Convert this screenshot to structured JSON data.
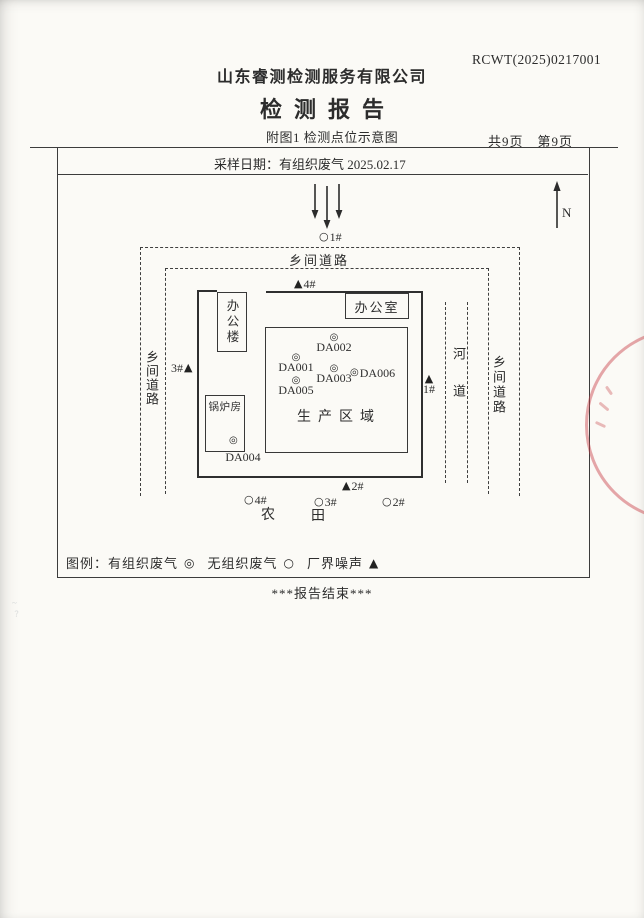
{
  "header": {
    "report_no": "RCWT(2025)0217001",
    "company": "山东睿测检测服务有限公司",
    "title": "检测报告",
    "figure_caption": "附图1 检测点位示意图",
    "page_info": "共9页　第9页",
    "sampling_date_row": "采样日期：有组织废气 2025.02.17"
  },
  "diagram": {
    "north_label": "N",
    "roads": {
      "top": "乡间道路",
      "left": "乡间道路",
      "right": "乡间道路"
    },
    "river_label": "河道",
    "office_building": "办公楼",
    "office_room": "办公室",
    "boiler_room": "锅炉房",
    "production_area": "生产区域",
    "farmland": {
      "char1": "农",
      "char2": "田"
    },
    "symbols": {
      "organized": "◎",
      "unorganized": "○",
      "noise": "▲"
    },
    "organized_points": [
      {
        "id": "DA001"
      },
      {
        "id": "DA002"
      },
      {
        "id": "DA003"
      },
      {
        "id": "DA004"
      },
      {
        "id": "DA005"
      },
      {
        "id": "DA006"
      }
    ],
    "noise_points": [
      {
        "id": "1#"
      },
      {
        "id": "2#"
      },
      {
        "id": "3#"
      },
      {
        "id": "4#"
      }
    ],
    "unorganized_points": [
      {
        "id": "1#"
      },
      {
        "id": "2#"
      },
      {
        "id": "3#"
      },
      {
        "id": "4#"
      }
    ]
  },
  "legend": {
    "label": "图例：",
    "items": [
      {
        "name": "有组织废气",
        "symbol": "◎"
      },
      {
        "name": "无组织废气",
        "symbol": "○"
      },
      {
        "name": "厂界噪声",
        "symbol": "▲"
      }
    ]
  },
  "footer": {
    "end_note": "***报告结束***"
  },
  "colors": {
    "ink": "#2f2f2f",
    "seal": "#c73e46",
    "paper": "#fbfaf6"
  }
}
